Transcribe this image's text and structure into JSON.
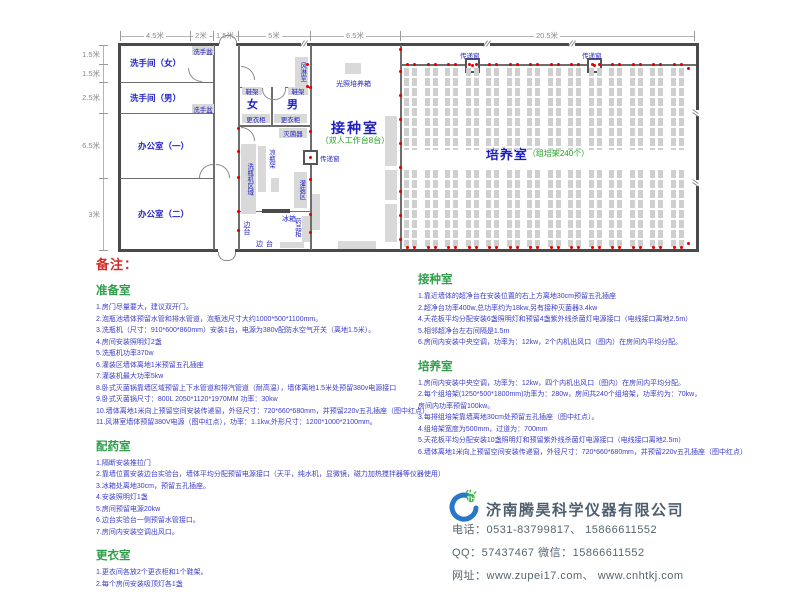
{
  "plan": {
    "dims_top": [
      "4.5米",
      "2米",
      "1.5米",
      "5米",
      "6.5米",
      "20.5米"
    ],
    "dims_left": [
      "1.5米",
      "1.5米",
      "2.5米",
      "6.5米",
      "3米"
    ],
    "rooms": {
      "wc_female": "洗手间（女）",
      "wc_male": "洗手间（男）",
      "office_1": "办公室（一）",
      "office_2": "办公室（二）",
      "dress_female": "女",
      "dress_male": "男",
      "inoculation_title": "接种室",
      "inoculation_sub": "（双人工作台8台）",
      "culture_title": "培养室",
      "culture_sub": "（组培架240个）"
    },
    "labels": {
      "washbasin": "洗手盆",
      "shoe_rack": "鞋架",
      "locker": "更衣柜",
      "air_shower": "风淋室",
      "sterilizer": "灭菌器",
      "cool_rack": "凉瓶架",
      "washer_area": "洗瓶机区域",
      "filling_area": "灌装区",
      "fridge": "冰箱",
      "side_bench": "边台",
      "medicine_cabinet": "药品柜",
      "light_incubator": "光照培养箱",
      "pass_window": "传递窗"
    },
    "culture_racks": {
      "columns": 14
    }
  },
  "notes": {
    "title": "备注：",
    "sections_left": [
      {
        "heading": "准备室",
        "items": [
          "1.房门尽量要大，建议双开门。",
          "2.泡瓶池墙体预留水管和排水管道，泡瓶池尺寸大约1000*500*1100mm。",
          "3.洗瓶机（尺寸：910*600*860mm）安装1台，电源为380v配防水空气开关（离地1.5米）。",
          "4.房间安装照明灯2盏",
          "5.洗瓶机功率370w",
          "6.灌装区墙体离地1米预留五孔插座",
          "7.灌装机最大功率5kw",
          "8.卧式灭菌锅靠墙区域预留上下水管道和排汽管道（耐高温），墙体离地1.5米处预留380v电源接口",
          "9.卧式灭菌锅尺寸：800L  2050*1120*1970MM  功率：30kw",
          "10.墙体离地1米向上预留空间安装传递窗，外径尺寸：720*660*680mm，并预留220v五孔插座（图中红点）",
          "11.风淋室墙体预留380V电源（图中红点），功率：1.1kw,外形尺寸：1200*1000*2100mm。"
        ]
      },
      {
        "heading": "配药室",
        "items": [
          "1.隔断安装推拉门",
          "2.靠墙位置安装边台实验台，墙体平均分配预留电源接口（天平，纯水机，显微镜，磁力加热搅拌器等仪器使用）",
          "3.冰箱处离地30cm，预留五孔插座。",
          "4.安装照明灯1盏",
          "5.房间预留电源20kw",
          "6.边台实验台一侧预留水管接口。",
          "7.房间内安装空调出风口。"
        ]
      },
      {
        "heading": "更衣室",
        "items": [
          "1.更衣间各放2个更衣柜和1个鞋架。",
          "2.每个房间安装吸顶灯各1盏"
        ]
      }
    ],
    "sections_right": [
      {
        "heading": "接种室",
        "items": [
          "1.靠近墙体的超净台在安装位置的右上方离地30cm预留五孔插座",
          "2.超净台功率400w,总功率约为18kw,另有接种灭菌器3.4kw",
          "4.天花板平均分配安装6盏照明灯和预留4盏紫外线杀菌灯电源接口（电线接口离地2.5m）",
          "5.相邻超净台左右间隔是1.5m",
          "6.房间内安装中央空调，功率为：12kw，2个内机出风口（图内）在房间内平均分配。"
        ]
      },
      {
        "heading": "培养室",
        "items": [
          "1.房间内安装中央空调，功率为：12kw，四个内机出风口（图内）在房间内平均分配。",
          "2.每个组培架(1250*500*1800mm)功率为：280w，房间共240个组培架，功率约为：70kw，",
          "房间内功率预留100kw。",
          "3.每排组培架靠墙离地30cm处预留五孔插座（图中红点）。",
          "4.组培架宽度为500mm，过道为：700mm",
          "5.天花板平均分配安装10盏照明灯和预留紫外线杀菌灯电源接口（电线接口离地2.5m）",
          "6.墙体离地1米向上预留空间安装传递窗，外径尺寸：720*660*680mm，并预留220v五孔插座（图中红点）"
        ]
      }
    ]
  },
  "company": {
    "name": "济南腾昊科学仪器有限公司",
    "logo_text": "TH",
    "phone": "电话：0531-83799817、 15866611552",
    "qq_wechat": "QQ：57437467    微信：15866611552",
    "website": "网址：www.zupei17.com、  www.cnhtkj.com"
  },
  "colors": {
    "wall": "#4a4a4a",
    "label_blue": "#2323c8",
    "room_green": "#22a022",
    "heading_green": "#2e9e4a",
    "note_blue": "#3c3cc8",
    "remark_red": "#d42a2a",
    "outlet_red": "#e10000",
    "equipment_gray": "#d9d9d9",
    "company_text": "#4e5f6e",
    "logo_blue": "#2878c8",
    "logo_green": "#3cb44b"
  }
}
